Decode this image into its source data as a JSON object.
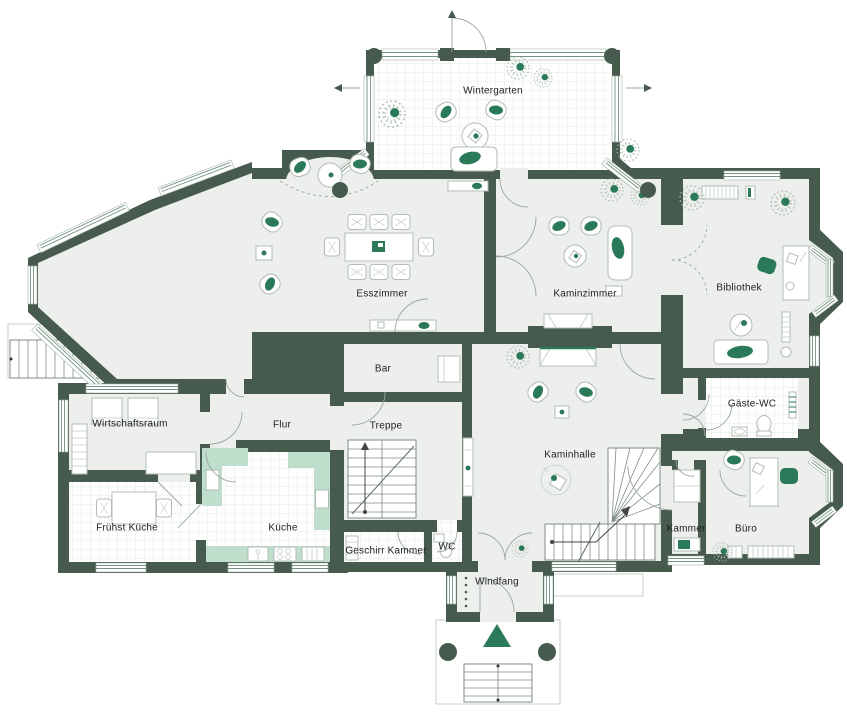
{
  "plan": {
    "type": "floor-plan",
    "colors": {
      "wall": "#465b4d",
      "floor": "#edefec",
      "tile_line": "#d9e6de",
      "accent_green": "#2a7a59",
      "counter_green": "#bfdecb",
      "window_line": "#72937f"
    },
    "icons": {
      "entrance_marker": "triangle-up-icon",
      "plant": "plant-icon",
      "north_door_arrow": "arrow-icon"
    }
  },
  "rooms": [
    {
      "id": "wintergarten",
      "label": "Wintergarten"
    },
    {
      "id": "esszimmer",
      "label": "Esszimmer"
    },
    {
      "id": "kaminzimmer",
      "label": "Kaminzimmer"
    },
    {
      "id": "bibliothek",
      "label": "Bibliothek"
    },
    {
      "id": "gaeste-wc",
      "label": "Gäste-WC"
    },
    {
      "id": "bar",
      "label": "Bar"
    },
    {
      "id": "treppe",
      "label": "Treppe"
    },
    {
      "id": "flur",
      "label": "Flur"
    },
    {
      "id": "wirtschaftsraum",
      "label": "Wirtschaftsraum"
    },
    {
      "id": "fruehst-kueche",
      "label": "Frühst Küche"
    },
    {
      "id": "kueche",
      "label": "Küche"
    },
    {
      "id": "geschirr-kammer",
      "label": "Geschirr Kammer"
    },
    {
      "id": "wc",
      "label": "WC"
    },
    {
      "id": "windfang",
      "label": "Windfang"
    },
    {
      "id": "kaminhalle",
      "label": "Kaminhalle"
    },
    {
      "id": "kammer",
      "label": "Kammer"
    },
    {
      "id": "buero",
      "label": "Büro"
    }
  ]
}
